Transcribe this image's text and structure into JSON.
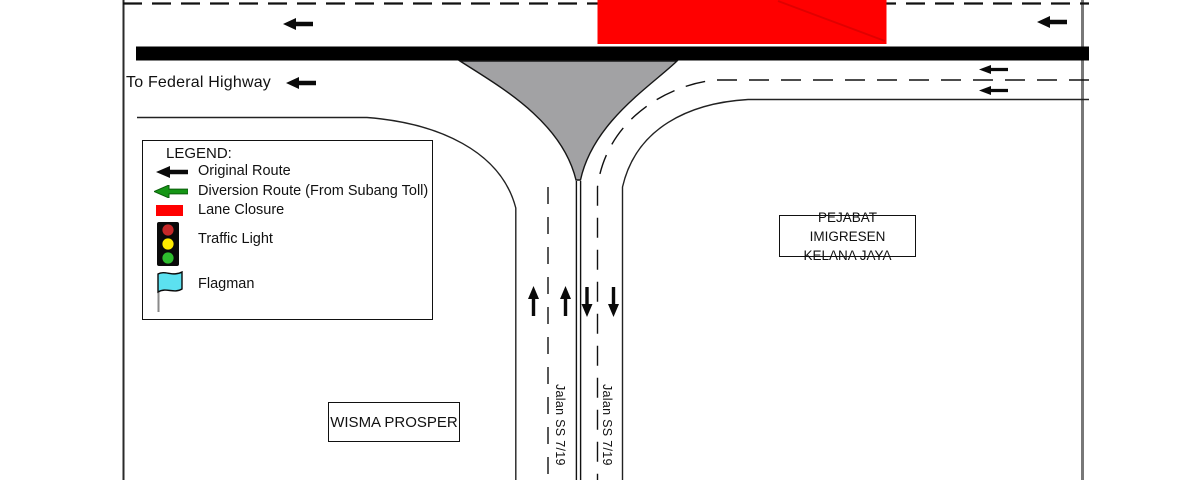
{
  "road_labels": {
    "to_federal_highway": "To Federal Highway",
    "jalan_ss_719_left": "Jalan SS 7/19",
    "jalan_ss_719_right": "Jalan SS 7/19"
  },
  "buildings": {
    "pejabat_imigresen": {
      "line1": "PEJABAT IMIGRESEN",
      "line2": "KELANA JAYA"
    },
    "wisma_prosper": "WISMA PROSPER"
  },
  "legend": {
    "title": "LEGEND:",
    "items": [
      {
        "icon": "black-arrow-icon",
        "label": "Original Route"
      },
      {
        "icon": "green-arrow-icon",
        "label": "Diversion Route (From Subang Toll)"
      },
      {
        "icon": "red-rect-icon",
        "label": "Lane Closure"
      },
      {
        "icon": "traffic-light-icon",
        "label": "Traffic Light"
      },
      {
        "icon": "flagman-flag-icon",
        "label": "Flagman"
      }
    ]
  },
  "colors": {
    "lane_closure_red": "#FF0000",
    "closure_hatch_red": "#E00000",
    "diversion_green": "#169616",
    "gore_island_gray": "#A2A2A4",
    "flag_cyan": "#5CE1F0",
    "traffic_light_red": "#C62828",
    "traffic_light_yellow": "#FFEB00",
    "traffic_light_green": "#2EBD2E"
  }
}
